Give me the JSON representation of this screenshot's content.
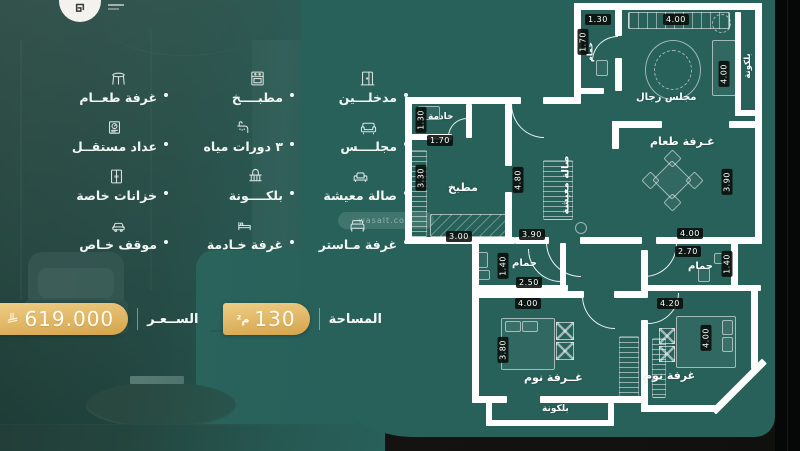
{
  "brand": {
    "logo_name": "home-mark-logo"
  },
  "features": {
    "items": [
      {
        "label": "مدخلـــين",
        "icon": "door-icon"
      },
      {
        "label": "مطبــــخ",
        "icon": "kitchen-icon"
      },
      {
        "label": "غرفة طعــام",
        "icon": "dining-icon"
      },
      {
        "label": "مجلــــس",
        "icon": "majlis-sofa-icon"
      },
      {
        "label": "٣ دورات مياه",
        "icon": "bathrooms-icon"
      },
      {
        "label": "عداد مستقــل",
        "icon": "meter-icon"
      },
      {
        "label": "صالة معيشة",
        "icon": "living-room-icon"
      },
      {
        "label": "بلكــــونة",
        "icon": "balcony-icon"
      },
      {
        "label": "خزانات خاصة",
        "icon": "closet-icon"
      },
      {
        "label": "غرفة مـاستر",
        "icon": "master-bed-icon"
      },
      {
        "label": "غرفة خـادمة",
        "icon": "maid-room-icon"
      },
      {
        "label": "موقف خـاص",
        "icon": "parking-icon"
      }
    ]
  },
  "info_bar": {
    "area_label": "المساحة",
    "area_value": "130",
    "area_unit": "م²",
    "price_label": "الســعـر",
    "price_value": "619.000",
    "currency_icon": "saudi-riyal-symbol"
  },
  "watermark": {
    "text": "wasalt.com"
  },
  "floor_plan": {
    "rooms": {
      "maid": "خادمة",
      "kitchen": "مطبخ",
      "living": "صالة معيشة",
      "bath_top": "حمام",
      "majlis": "مجلس رجال",
      "dining": "غـرفة طعام",
      "bath_left": "حمام",
      "bath_right": "حمام",
      "bedroom_left": "غــرفة نوم",
      "bedroom_right": "غرفة نوم",
      "balcony_side": "بلكونة",
      "balcony_bottom": "بلكونة"
    },
    "dims": {
      "maid_h": "1.30",
      "maid_w": "1.70",
      "kitchen_h": "3.30",
      "kitchen_w": "3.00",
      "living_h": "4.80",
      "living_w": "3.90",
      "bath_top_w": "1.30",
      "bath_top_h": "1.70",
      "majlis_w": "4.00",
      "majlis_h": "4.00",
      "dining_h": "3.90",
      "dining_w": "4.00",
      "bath_left_h": "1.40",
      "bath_left_w": "2.50",
      "bath_right_w": "2.70",
      "bath_right_h": "1.40",
      "bedroom_left_w": "4.00",
      "bedroom_left_h": "3.80",
      "bedroom_right_w": "4.20",
      "bedroom_right_h": "4.00"
    }
  },
  "colors": {
    "panel_teal": "#28605a",
    "gold_start": "#eecd84",
    "gold_end": "#d5a44c",
    "wall_white": "#fdfefd",
    "chip_black": "#080c0a"
  }
}
